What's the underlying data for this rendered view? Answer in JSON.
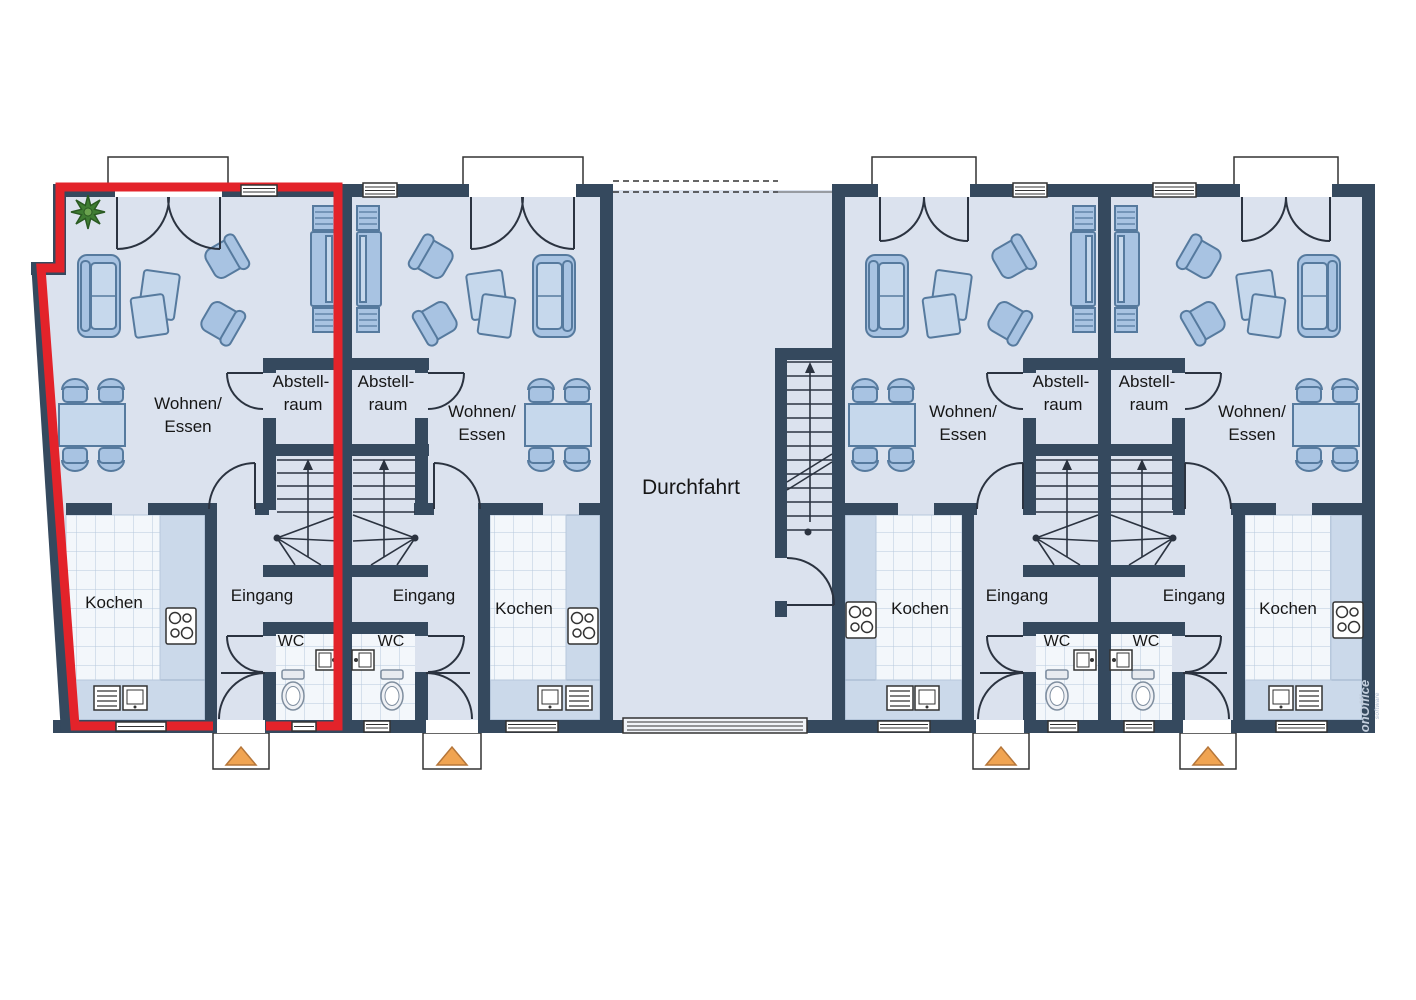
{
  "plan": {
    "passage_label": "Durchfahrt",
    "units": [
      {
        "living_line1": "Wohnen/",
        "living_line2": "Essen",
        "storage_line1": "Abstell-",
        "storage_line2": "raum",
        "kitchen": "Kochen",
        "entrance": "Eingang",
        "wc": "WC"
      },
      {
        "living_line1": "Wohnen/",
        "living_line2": "Essen",
        "storage_line1": "Abstell-",
        "storage_line2": "raum",
        "kitchen": "Kochen",
        "entrance": "Eingang",
        "wc": "WC"
      },
      {
        "living_line1": "Wohnen/",
        "living_line2": "Essen",
        "storage_line1": "Abstell-",
        "storage_line2": "raum",
        "kitchen": "Kochen",
        "entrance": "Eingang",
        "wc": "WC"
      },
      {
        "living_line1": "Wohnen/",
        "living_line2": "Essen",
        "storage_line1": "Abstell-",
        "storage_line2": "raum",
        "kitchen": "Kochen",
        "entrance": "Eingang",
        "wc": "WC"
      }
    ],
    "highlight": {
      "unit_index": 0,
      "color": "#e3232a"
    },
    "watermark": {
      "brand": "onOffice",
      "sub": "software"
    },
    "colors": {
      "wall": "#35495e",
      "room": "#dbe2ee",
      "furniture": "#a8c3e2",
      "furniture_stroke": "#567a9e",
      "furniture_light": "#c6d8ec",
      "tile_bg": "#f3f7fb",
      "tile_line": "#b7c8dc",
      "counter": "#cbd9ea",
      "highlight_red": "#e3232a",
      "arrow_orange": "#f0a452"
    }
  }
}
